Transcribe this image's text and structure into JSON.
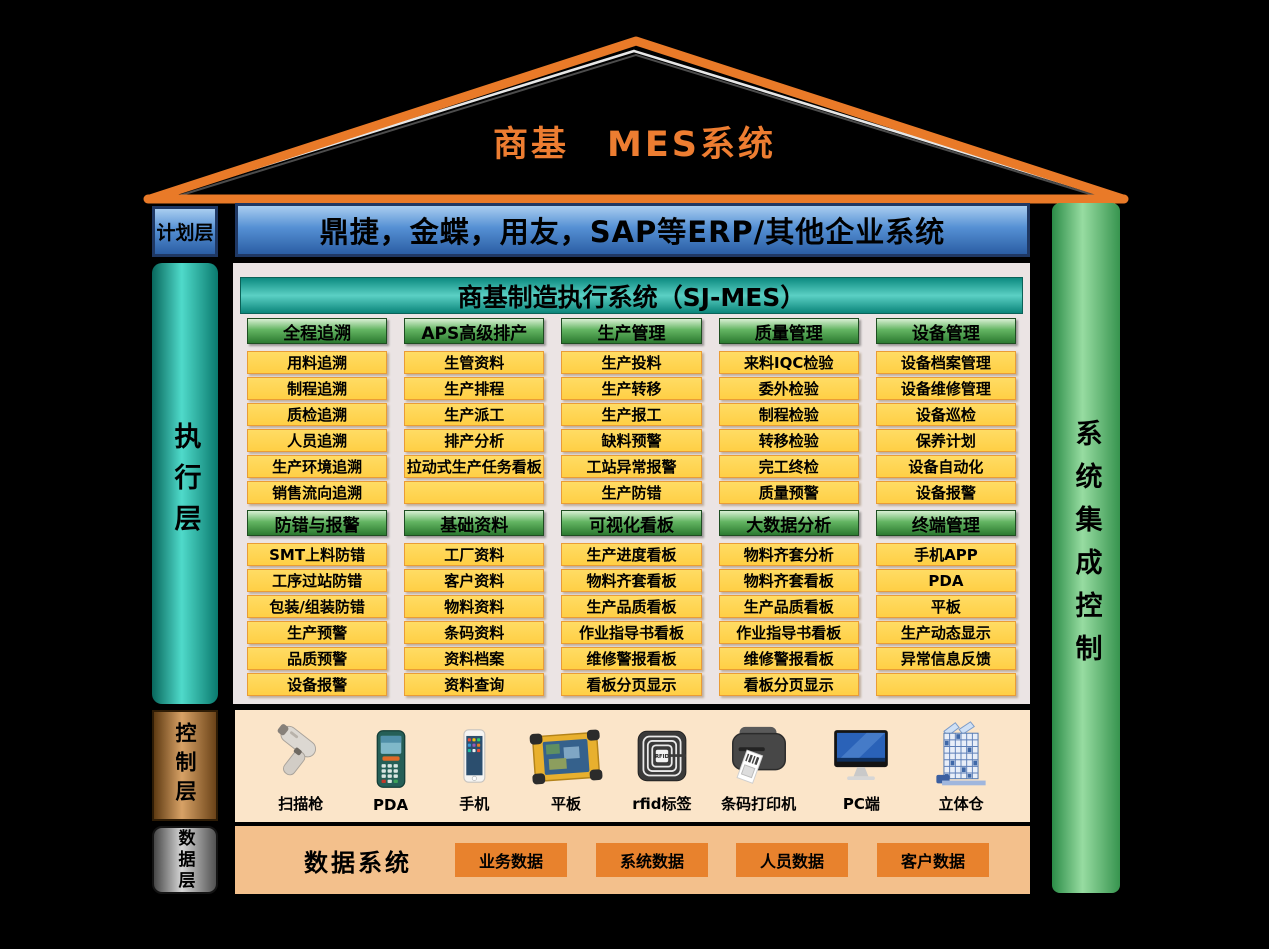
{
  "roof": {
    "title": "商基　MES系统"
  },
  "planning": {
    "label": "计划层",
    "erp_text": "鼎捷，金蝶，用友，SAP等ERP/其他企业系统"
  },
  "execution": {
    "label": "执行层",
    "system_title": "商基制造执行系统（SJ-MES）",
    "sections": [
      {
        "columns": [
          {
            "header": "全程追溯",
            "items": [
              "用料追溯",
              "制程追溯",
              "质检追溯",
              "人员追溯",
              "生产环境追溯",
              "销售流向追溯"
            ]
          },
          {
            "header": "APS高级排产",
            "items": [
              "生管资料",
              "生产排程",
              "生产派工",
              "排产分析",
              "拉动式生产任务看板",
              ""
            ]
          },
          {
            "header": "生产管理",
            "items": [
              "生产投料",
              "生产转移",
              "生产报工",
              "缺料预警",
              "工站异常报警",
              "生产防错"
            ]
          },
          {
            "header": "质量管理",
            "items": [
              "来料IQC检验",
              "委外检验",
              "制程检验",
              "转移检验",
              "完工终检",
              "质量预警"
            ]
          },
          {
            "header": "设备管理",
            "items": [
              "设备档案管理",
              "设备维修管理",
              "设备巡检",
              "保养计划",
              "设备自动化",
              "设备报警"
            ]
          }
        ]
      },
      {
        "columns": [
          {
            "header": "防错与报警",
            "items": [
              "SMT上料防错",
              "工序过站防错",
              "包装/组装防错",
              "生产预警",
              "品质预警",
              "设备报警"
            ]
          },
          {
            "header": "基础资料",
            "items": [
              "工厂资料",
              "客户资料",
              "物料资料",
              "条码资料",
              "资料档案",
              "资料查询"
            ]
          },
          {
            "header": "可视化看板",
            "items": [
              "生产进度看板",
              "物料齐套看板",
              "生产品质看板",
              "作业指导书看板",
              "维修警报看板",
              "看板分页显示"
            ]
          },
          {
            "header": "大数据分析",
            "items": [
              "物料齐套分析",
              "物料齐套看板",
              "生产品质看板",
              "作业指导书看板",
              "维修警报看板",
              "看板分页显示"
            ]
          },
          {
            "header": "终端管理",
            "items": [
              "手机APP",
              "PDA",
              "平板",
              "生产动态显示",
              "异常信息反馈",
              ""
            ]
          }
        ]
      }
    ]
  },
  "integration": {
    "label": "系统集成控制"
  },
  "control": {
    "label": "控制层",
    "devices": [
      {
        "label": "扫描枪",
        "icon": "barcode-scanner-icon"
      },
      {
        "label": "PDA",
        "icon": "pda-icon"
      },
      {
        "label": "手机",
        "icon": "phone-icon"
      },
      {
        "label": "平板",
        "icon": "tablet-icon"
      },
      {
        "label": "rfid标签",
        "icon": "rfid-tag-icon"
      },
      {
        "label": "条码打印机",
        "icon": "label-printer-icon"
      },
      {
        "label": "PC端",
        "icon": "pc-monitor-icon"
      },
      {
        "label": "立体仓",
        "icon": "warehouse-icon"
      }
    ]
  },
  "data_layer": {
    "label": "数据层",
    "system_label": "数据系统",
    "chips": [
      "业务数据",
      "系统数据",
      "人员数据",
      "客户数据"
    ]
  },
  "colors": {
    "roof_orange": "#E97A28",
    "title_orange": "#ED7D31",
    "erp_blue": "#5590D4",
    "exec_teal": "#0C8A80",
    "module_green": "#63B562",
    "module_yellow": "#FFD451",
    "integration_green": "#97DCA1",
    "control_copper": "#D8A266",
    "data_tan": "#F3C08C",
    "data_chip_orange": "#E8822D",
    "background": "#000000"
  }
}
